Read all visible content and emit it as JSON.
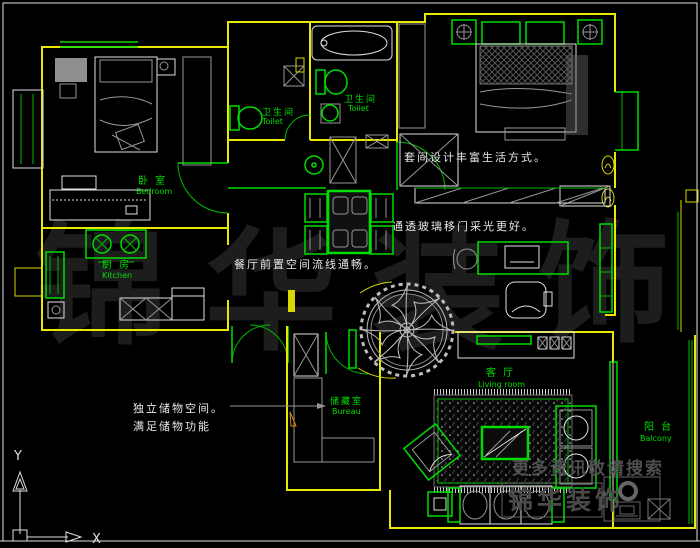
{
  "app": {
    "type": "cad-floor-plan-view"
  },
  "colors": {
    "background": "#000000",
    "wall": "#e8e800",
    "fixture": "#00dd00",
    "outline_white": "#e0e0e0",
    "annotation_text": "#e8e8e8",
    "watermark_big": "#1d1d1d",
    "watermark_small": "#4a4a4a"
  },
  "rooms": {
    "bedroom": {
      "zh": "卧 室",
      "en": "Bedroom"
    },
    "toilet_left": {
      "zh": "卫生间",
      "en": "Toilet"
    },
    "toilet_right": {
      "zh": "卫生间",
      "en": "Toilet"
    },
    "kitchen": {
      "zh": "厨 房",
      "en": "Kitchen"
    },
    "bureau": {
      "zh": "储藏室",
      "en": "Bureau"
    },
    "living": {
      "zh": "客 厅",
      "en": "Living room"
    },
    "balcony": {
      "zh": "阳 台",
      "en": "Balcony"
    }
  },
  "annotations": {
    "suite": "套间设计丰富生活方式。",
    "glass_door": "通透玻璃移门采光更好。",
    "dining": "餐厅前置空间流线通畅。",
    "storage_line1": "独立储物空间。",
    "storage_line2": "满足储物功能"
  },
  "watermark": {
    "brand_chars": [
      "锦",
      "华",
      "装",
      "饰"
    ],
    "tagline": "更多资讯敬请搜索",
    "brand_small": "锦华装饰"
  },
  "axis": {
    "x": "X",
    "y": "Y"
  }
}
